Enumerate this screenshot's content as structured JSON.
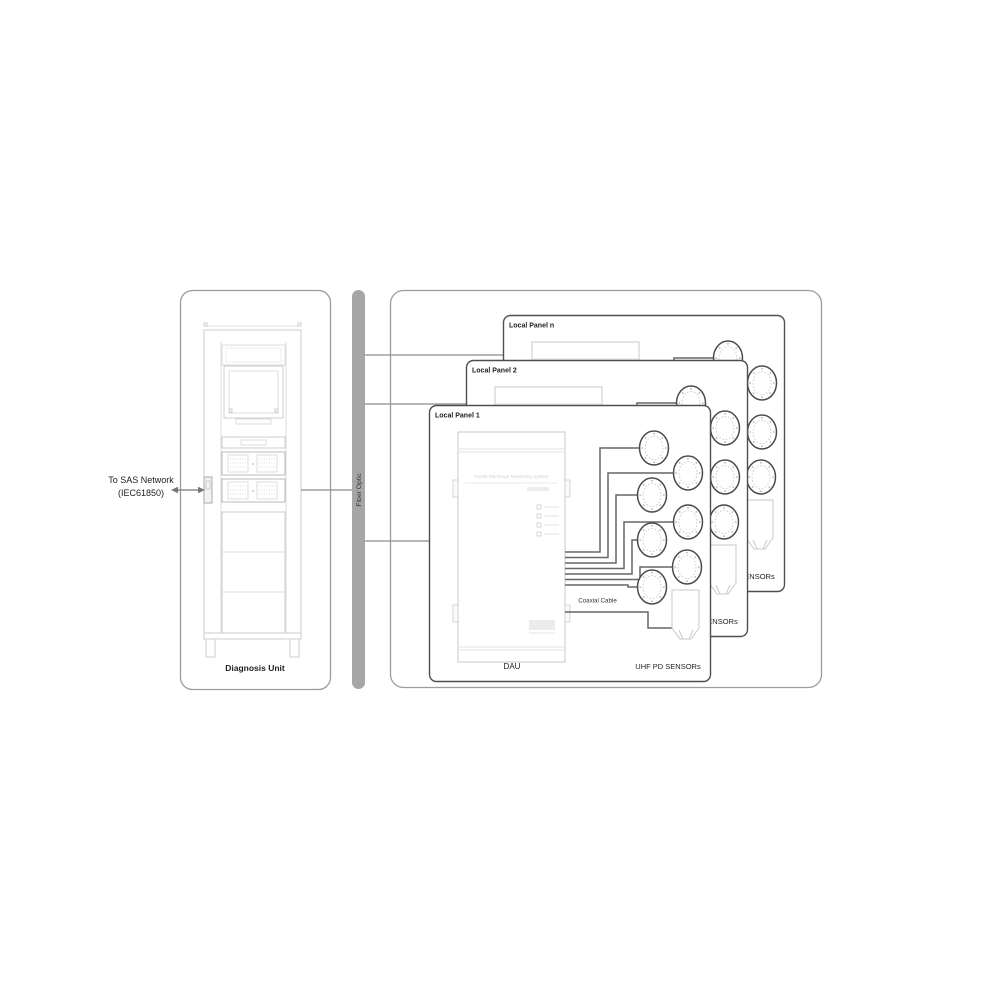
{
  "diagram": {
    "left_unit": {
      "label": "Diagnosis Unit",
      "network_line1": "To SAS Network",
      "network_line2": "(IEC61850)"
    },
    "bus": {
      "label": "Fiber Optic"
    },
    "right_group": {
      "panels": [
        {
          "title": "Local Panel n"
        },
        {
          "title": "Local Panel 2"
        },
        {
          "title": "Local Panel 1"
        }
      ],
      "panel_content": {
        "device_label": "DAU",
        "device_title": "Partial Discharge Monitoring System",
        "cable_label": "Coaxial Cable",
        "sensors_label": "UHF PD SENSORs",
        "round_sensor_count": 7,
        "plug_sensor_count": 1
      }
    },
    "colors": {
      "bus_fill": "#a6a6a6",
      "panel_border": "#4f4f4f",
      "wire": "#666666",
      "frame_border": "#9c9c9c",
      "rack_line": "#cccccc",
      "text": "#222222"
    }
  }
}
